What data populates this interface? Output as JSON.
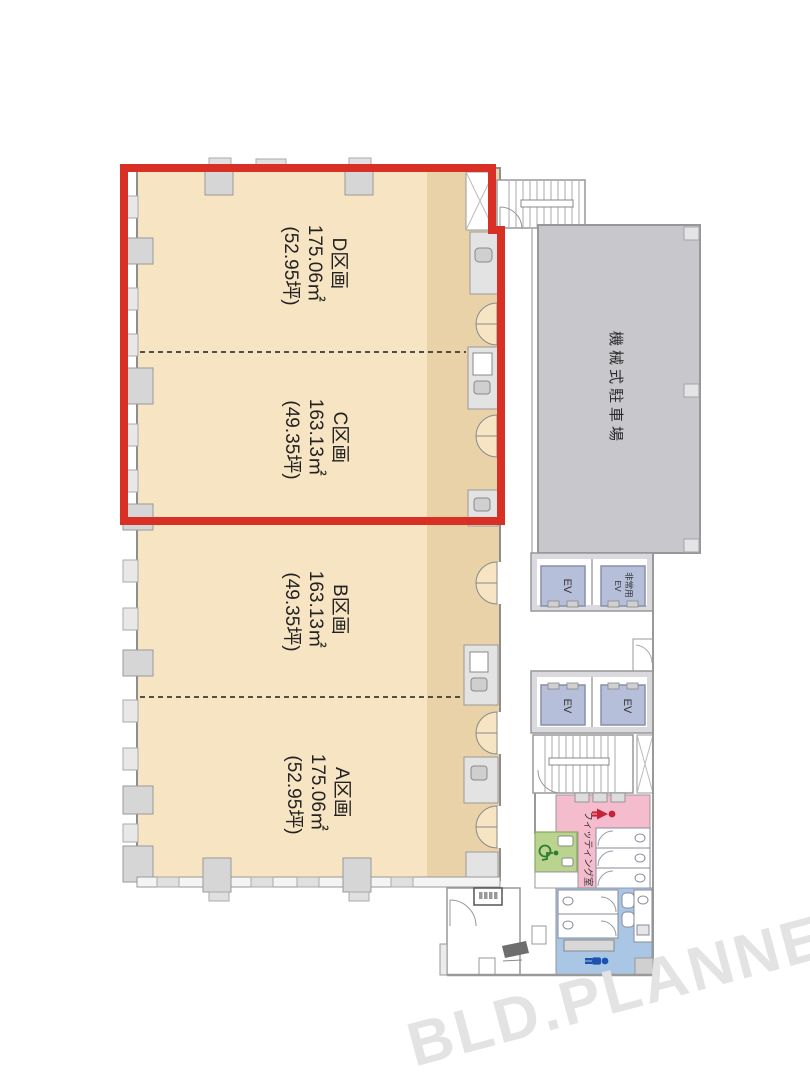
{
  "plan_title": "floor-plan",
  "sections": [
    {
      "id": "D",
      "name": "D区画",
      "area_sqm": "175.06㎡",
      "area_tsubo": "(52.95坪)"
    },
    {
      "id": "C",
      "name": "C区画",
      "area_sqm": "163.13㎡",
      "area_tsubo": "(49.35坪)"
    },
    {
      "id": "B",
      "name": "B区画",
      "area_sqm": "163.13㎡",
      "area_tsubo": "(49.35坪)"
    },
    {
      "id": "A",
      "name": "A区画",
      "area_sqm": "175.06㎡",
      "area_tsubo": "(52.95坪)"
    }
  ],
  "facilities": {
    "parking_label": "機械式駐車場",
    "elevator_label": "EV",
    "emergency_elevator": {
      "line1": "非常用",
      "line2": "EV"
    },
    "fitting_room_label": "フィッティング室"
  },
  "watermark": "BLD.PLANNER",
  "colors": {
    "highlight_red": "#d93026",
    "section_fill": "#f7e4c3",
    "section_fill_dark": "#e9d2a8",
    "parking_fill": "#c8c8cc",
    "elevator_fill": "#b5bfd9",
    "womens_fill": "#f5bccd",
    "mens_fill": "#a9c6e5",
    "accessible_fill": "#bad48f",
    "female_icon": "#c62238",
    "male_icon": "#1c52b0",
    "wheelchair_icon": "#2e7d32",
    "watermark_gray": "#e3e3e3"
  }
}
